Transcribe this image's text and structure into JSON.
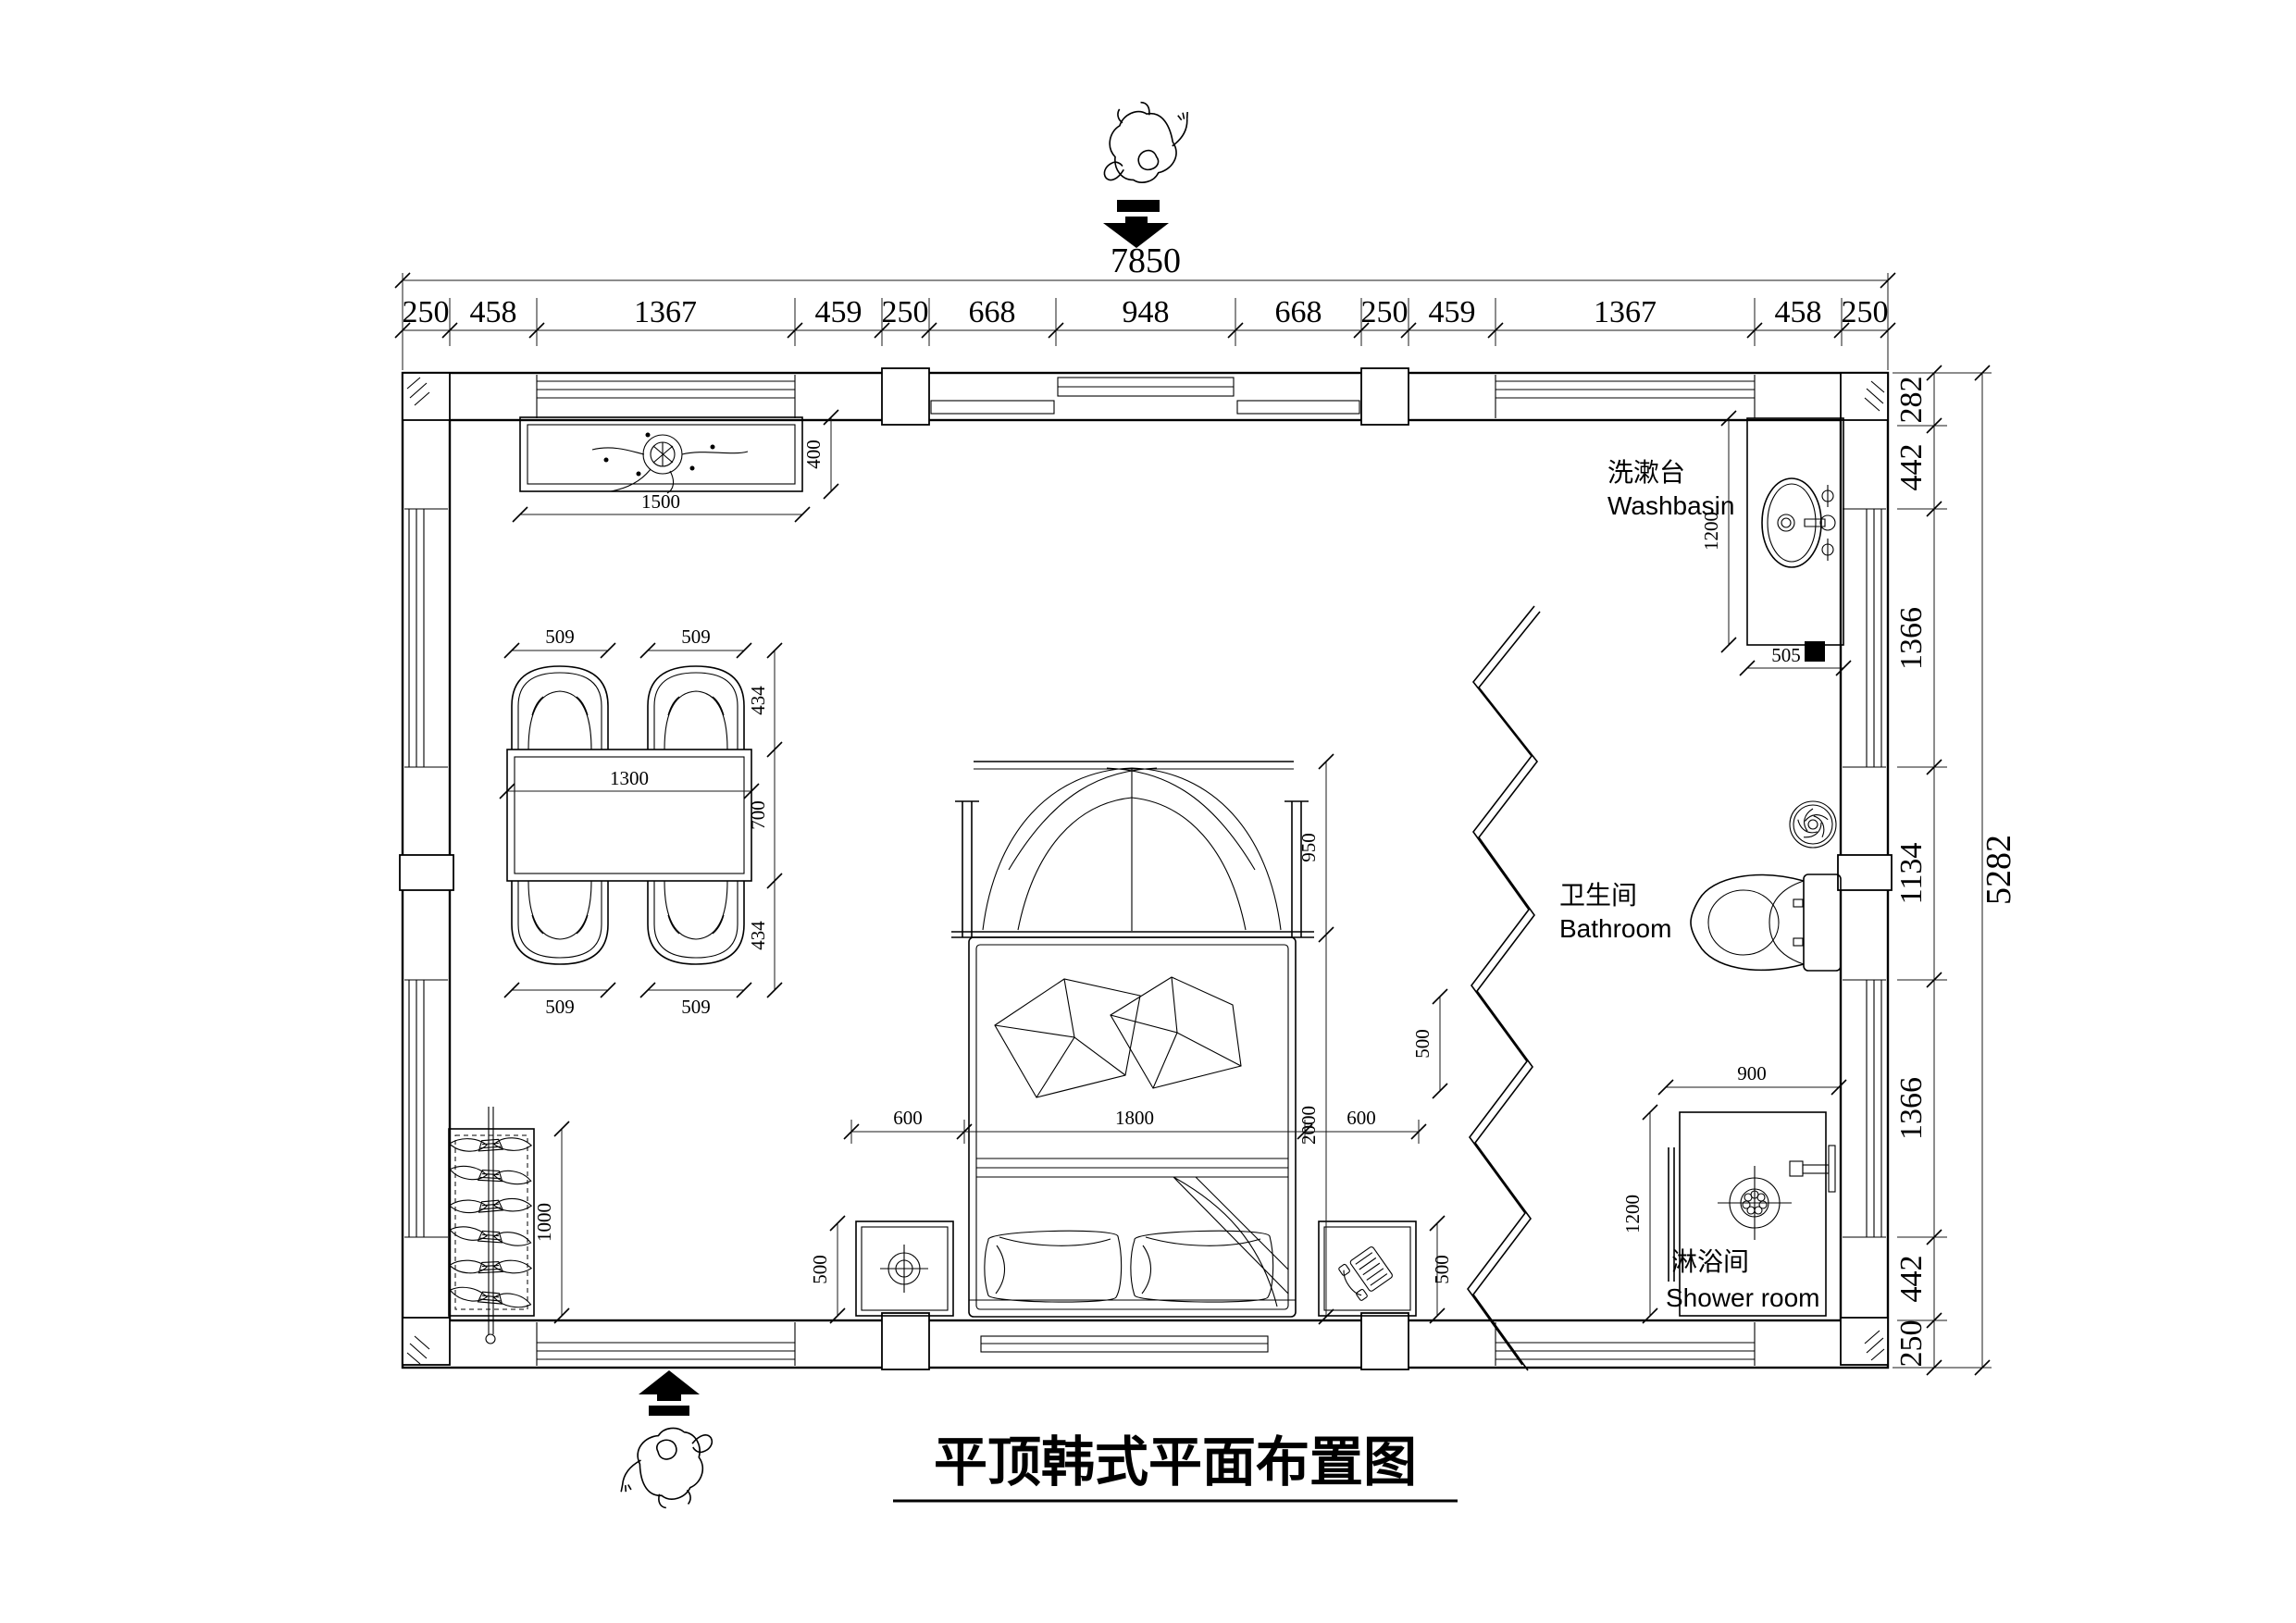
{
  "title": {
    "text": "平顶韩式平面布置图"
  },
  "dimensions": {
    "top": {
      "overall": "7850",
      "segments": [
        "250",
        "458",
        "1367",
        "459",
        "250",
        "668",
        "948",
        "668",
        "250",
        "459",
        "1367",
        "458",
        "250"
      ]
    },
    "right": {
      "overall": "5282",
      "segments": [
        "282",
        "442",
        "1366",
        "1134",
        "1366",
        "442",
        "250"
      ]
    },
    "ceiling_lamp": {
      "width": "1500",
      "height": "400"
    },
    "dining": {
      "chair_top_left": "509",
      "chair_top_right": "509",
      "chair_bottom_left": "509",
      "chair_bottom_right": "509",
      "side": [
        "434",
        "700",
        "434"
      ],
      "table_width": "1300"
    },
    "bed": {
      "canopy": "950",
      "length": "2000",
      "row": [
        "600",
        "1800",
        "600"
      ],
      "nightstand_left": "500",
      "nightstand_right": "500",
      "clearance": "500"
    },
    "wardrobe": {
      "length": "1000"
    },
    "washbasin": {
      "depth": "1200",
      "width": "505"
    },
    "shower": {
      "width": "900",
      "depth": "1200"
    }
  },
  "labels": {
    "washbasin": {
      "zh": "洗漱台",
      "en": "Washbasin"
    },
    "bathroom": {
      "zh": "卫生间",
      "en": "Bathroom"
    },
    "shower": {
      "zh": "淋浴间",
      "en": "Shower room"
    }
  }
}
